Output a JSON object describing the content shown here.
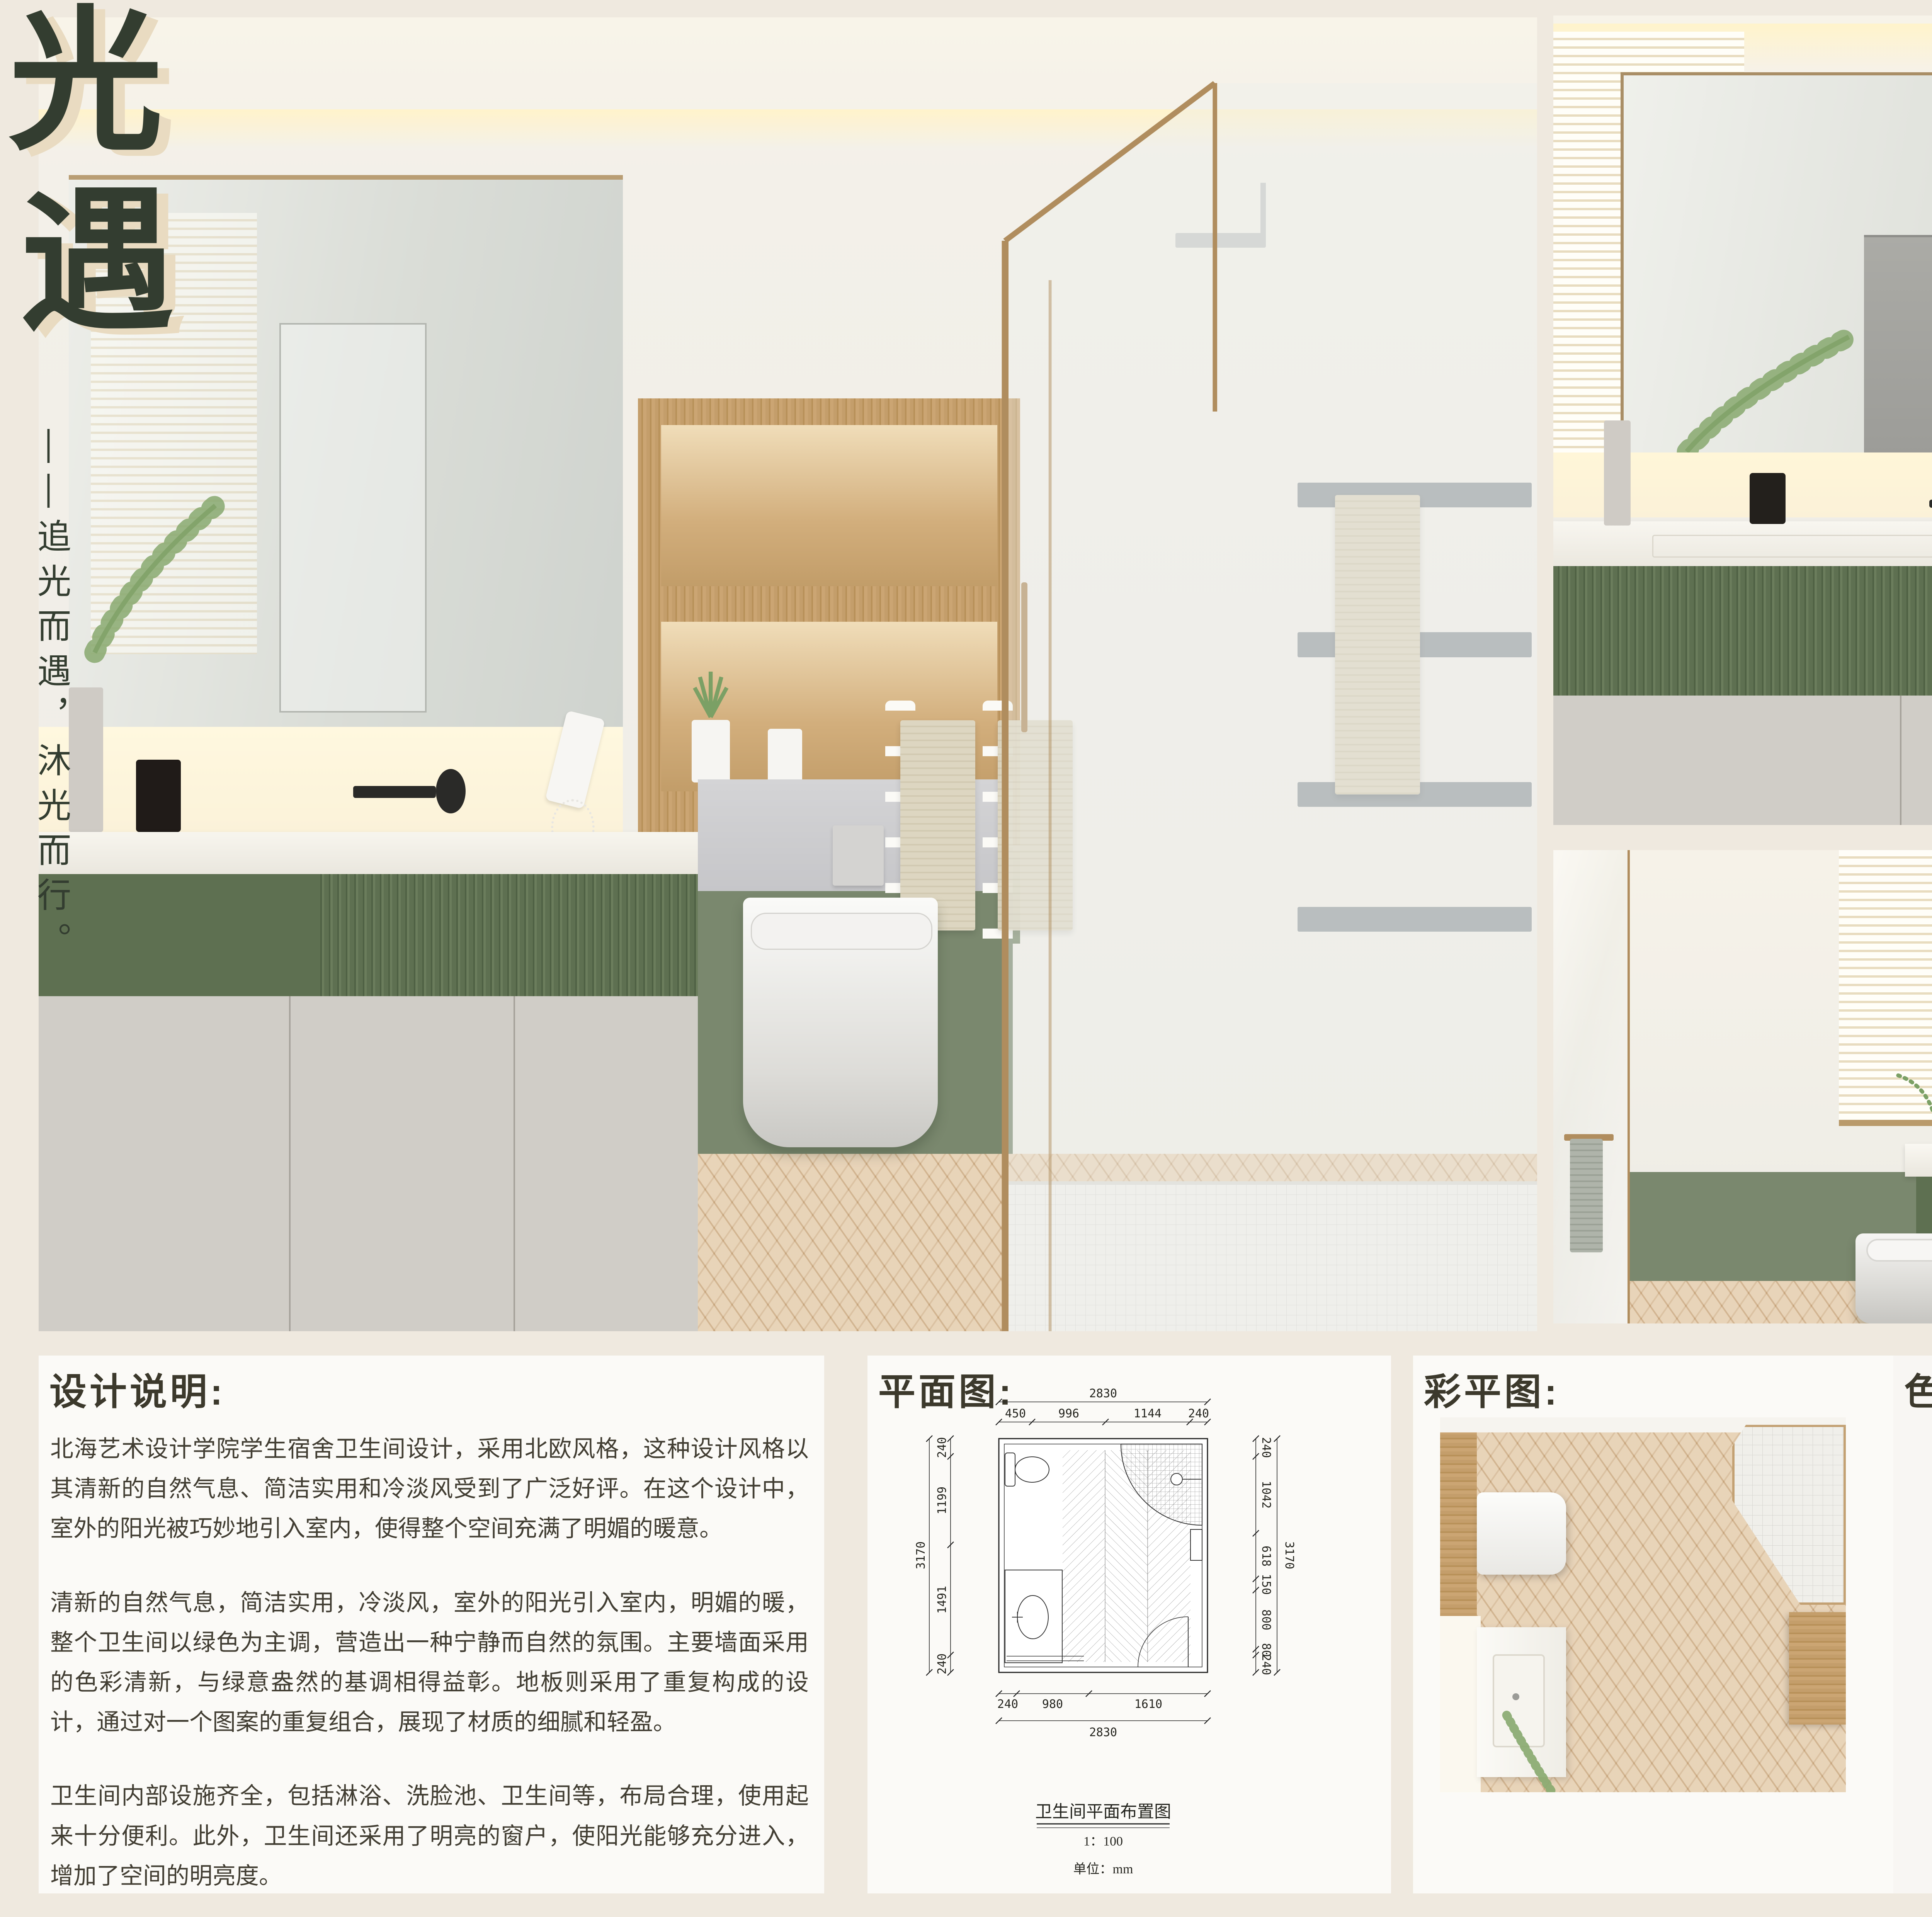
{
  "poster": {
    "title": {
      "characters": [
        "光",
        "遇"
      ],
      "tagline": "——追光而遇，沐光而行。"
    },
    "colors": {
      "background": "#EFE9DF",
      "title_ink": "#333D30",
      "title_shadow": "#E9DBC1",
      "sage_wall": "#7A886E",
      "vanity_green": "#5E7051",
      "wood": "#C49E6B",
      "floor_wood": "#DEC19B"
    }
  },
  "design_notes": {
    "label": "设计说明:",
    "paragraphs": [
      "北海艺术设计学院学生宿舍卫生间设计，采用北欧风格，这种设计风格以其清新的自然气息、简洁实用和冷淡风受到了广泛好评。在这个设计中，室外的阳光被巧妙地引入室内，使得整个空间充满了明媚的暖意。",
      "清新的自然气息，简洁实用，冷淡风，室外的阳光引入室内，明媚的暖，整个卫生间以绿色为主调，营造出一种宁静而自然的氛围。主要墙面采用的色彩清新，与绿意盎然的基调相得益彰。地板则采用了重复构成的设计，通过对一个图案的重复组合，展现了材质的细腻和轻盈。",
      "卫生间内部设施齐全，包括淋浴、洗脸池、卫生间等，布局合理，使用起来十分便利。此外，卫生间还采用了明亮的窗户，使阳光能够充分进入，增加了空间的明亮度。"
    ]
  },
  "floor_plan": {
    "label": "平面图:",
    "caption_title": "卫生间平面布置图",
    "caption_scale": "1：100",
    "caption_unit": "单位：mm",
    "dims": {
      "total_width": "2830",
      "total_height": "3170",
      "top_segments": [
        "450",
        "996",
        "1144",
        "240"
      ],
      "bottom_segments": [
        "240",
        "980",
        "1610"
      ],
      "left_segments": [
        "240",
        "1199",
        "1491",
        "240"
      ],
      "right_segments": [
        "240",
        "1042",
        "618",
        "150",
        "800",
        "80",
        "240"
      ]
    }
  },
  "color_plan": {
    "label": "彩平图:"
  },
  "palette": {
    "label": "色彩搭配:",
    "swatches": [
      {
        "name": "light-gray",
        "hex": "#D9D5D2"
      },
      {
        "name": "dark-brown",
        "hex": "#6E593C"
      },
      {
        "name": "cream-beige",
        "hex": "#E7D8BC"
      },
      {
        "name": "leaf-green",
        "hex": "#6B8F44"
      },
      {
        "name": "taupe",
        "hex": "#A89886"
      },
      {
        "name": "dark-olive",
        "hex": "#4B5542"
      },
      {
        "name": "tan-brown",
        "hex": "#B4917D"
      },
      {
        "name": "forest-green",
        "hex": "#2D392E"
      }
    ]
  }
}
